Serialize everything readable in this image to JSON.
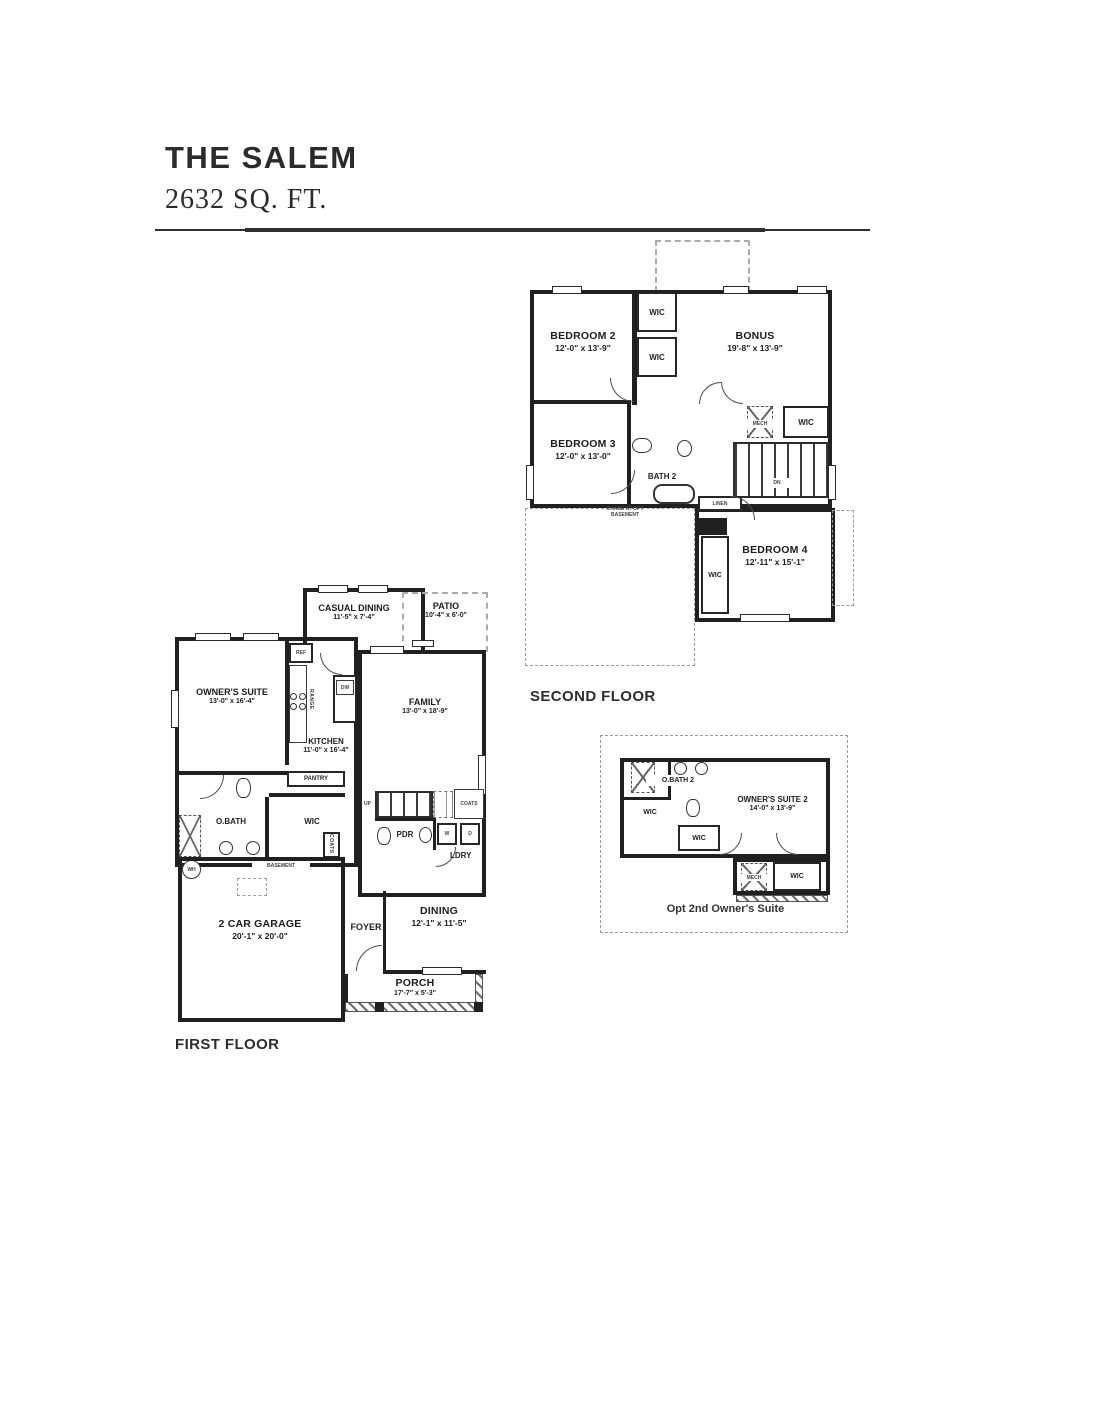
{
  "page": {
    "title": "THE SALEM",
    "subtitle": "2632 SQ. FT."
  },
  "colors": {
    "wall": "#202020",
    "text": "#1c1c1c",
    "dashed_outline": "#9a9a9a",
    "background": "#ffffff"
  },
  "second_floor": {
    "caption": "SECOND FLOOR",
    "bedroom2_name": "BEDROOM 2",
    "bedroom2_dims": "12'-0\" x 13'-9\"",
    "bonus_name": "BONUS",
    "bonus_dims": "19'-8\" x 13'-9\"",
    "bedroom3_name": "BEDROOM 3",
    "bedroom3_dims": "12'-0\" x 13'-0\"",
    "bedroom4_name": "BEDROOM 4",
    "bedroom4_dims": "12'-11\" x 15'-1\"",
    "bath2": "BATH 2",
    "wic_top": "WIC",
    "wic_mid": "WIC",
    "wic_right": "WIC",
    "wic_bed4": "WIC",
    "mech": "MECH",
    "linen": "LINEN",
    "down": "DN",
    "chase_note_line1": "CHASE AT OPT",
    "chase_note_line2": "BASEMENT"
  },
  "first_floor": {
    "caption": "FIRST FLOOR",
    "casual_dining_name": "CASUAL DINING",
    "casual_dining_dims": "11'-5\" x 7'-4\"",
    "patio_name": "PATIO",
    "patio_dims": "10'-4\" x 6'-0\"",
    "owners_suite_name": "OWNER'S SUITE",
    "owners_suite_dims": "13'-0\" x 16'-4\"",
    "kitchen_name": "KITCHEN",
    "kitchen_dims": "11'-0\" x 16'-4\"",
    "family_name": "FAMILY",
    "family_dims": "13'-0\" x 18'-9\"",
    "garage_name": "2 CAR GARAGE",
    "garage_dims": "20'-1\" x 20'-0\"",
    "dining_name": "DINING",
    "dining_dims": "12'-1\" x 11'-5\"",
    "porch_name": "PORCH",
    "porch_dims": "17'-7\" x 5'-3\"",
    "foyer": "FOYER",
    "obath": "O.BATH",
    "wic": "WIC",
    "pantry": "PANTRY",
    "pdr": "PDR",
    "ldry": "LDRY",
    "coats_stair": "COATS",
    "coats_closet": "COATS",
    "ref": "REF",
    "dw": "DW",
    "range": "RANGE",
    "washer": "W",
    "dryer": "D",
    "water_heater": "WH",
    "up": "UP",
    "chase_note_line1": "CHASE AT OPT",
    "chase_note_line2": "BASEMENT"
  },
  "optional_suite": {
    "caption": "Opt 2nd Owner's Suite",
    "obath2": "O.BATH 2",
    "owners_suite2_name": "OWNER'S SUITE 2",
    "owners_suite2_dims": "14'-0\" x 13'-9\"",
    "wic_left": "WIC",
    "wic_mid": "WIC",
    "wic_right": "WIC",
    "mech": "MECH"
  }
}
